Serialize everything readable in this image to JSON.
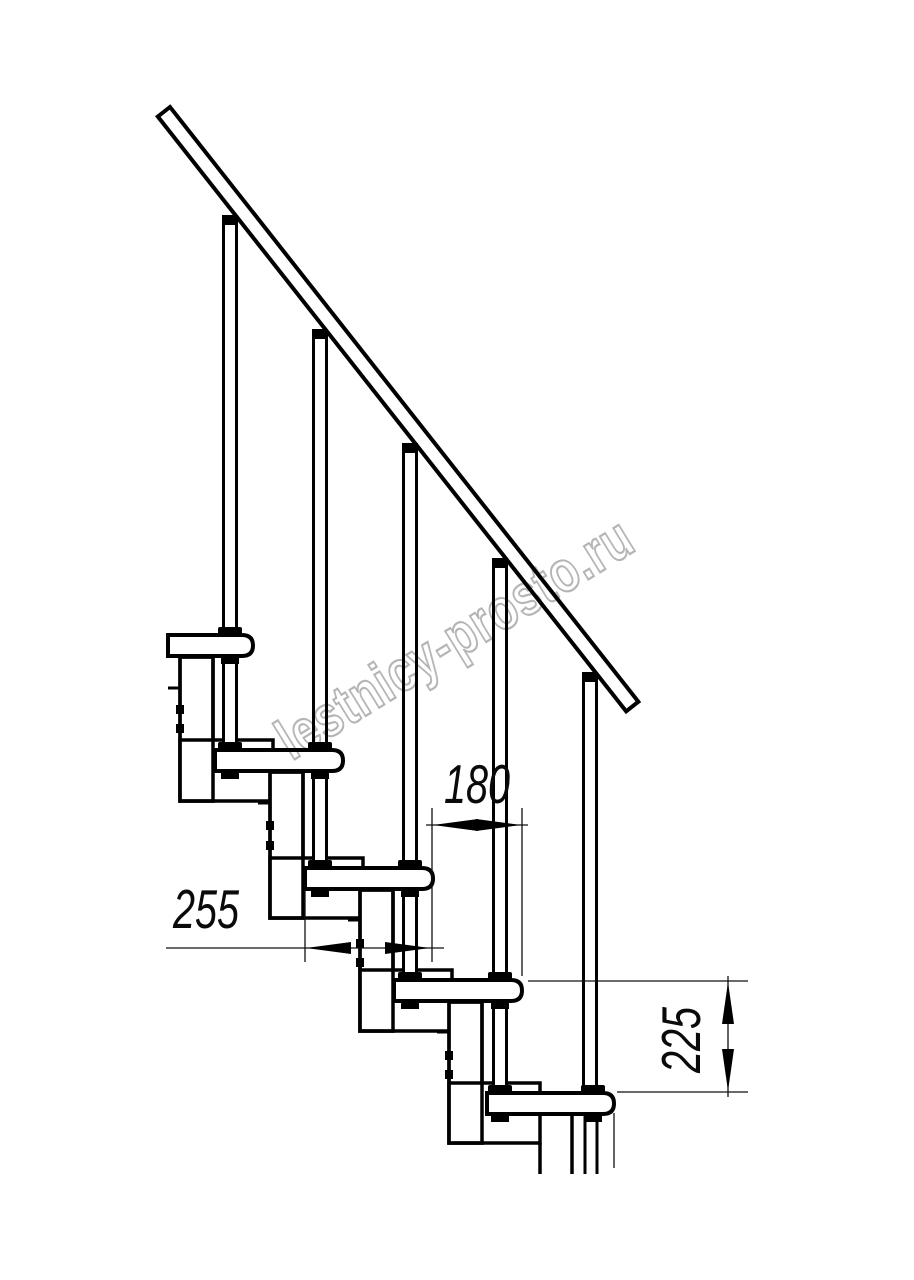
{
  "drawing": {
    "type": "technical-drawing",
    "subject": "modular staircase side elevation",
    "units": "mm",
    "background": "#ffffff",
    "line_color": "#000000",
    "watermark": {
      "text": "lestnicy-prosto.ru",
      "color": "#b5b5b5"
    },
    "dimensions": [
      {
        "id": "step-run",
        "value": "180",
        "orientation": "horizontal",
        "measures": "horizontal offset between step noses"
      },
      {
        "id": "tread-depth",
        "value": "255",
        "orientation": "horizontal",
        "measures": "tread depth"
      },
      {
        "id": "step-rise",
        "value": "225",
        "orientation": "vertical",
        "measures": "rise between steps"
      }
    ],
    "parts": {
      "handrail_count": 1,
      "tread_count": 5,
      "baluster_count": 5,
      "support_column_count": 5
    }
  }
}
